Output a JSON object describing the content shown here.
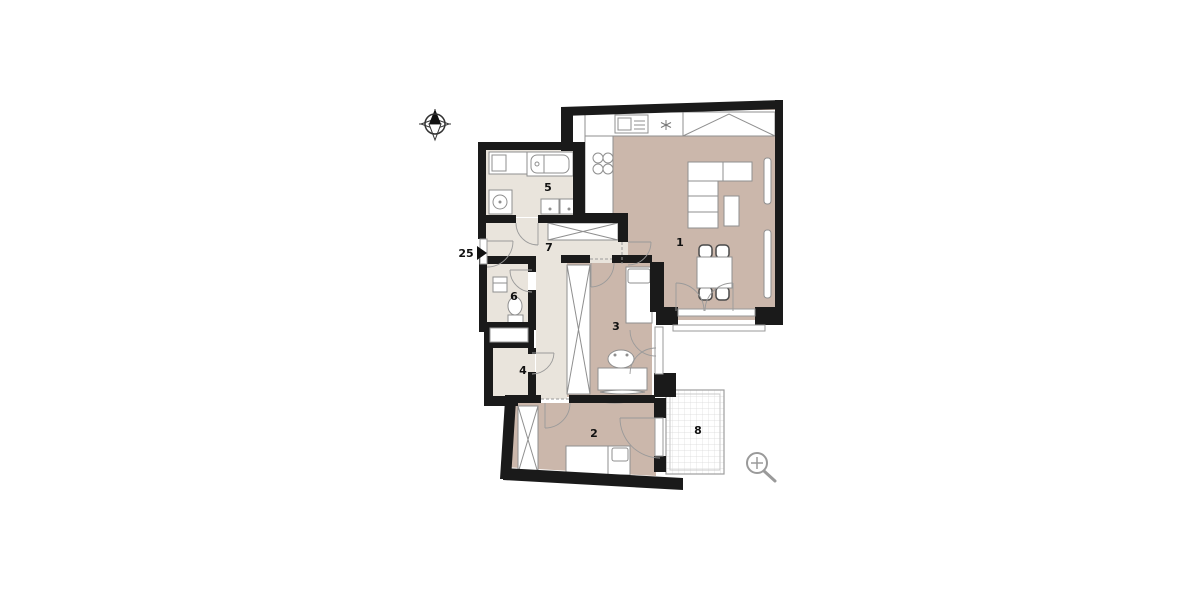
{
  "canvas": {
    "width": 1200,
    "height": 600,
    "background": "#ffffff"
  },
  "plan": {
    "entrance": {
      "label": "25"
    },
    "rooms": [
      {
        "number": "1"
      },
      {
        "number": "2"
      },
      {
        "number": "3"
      },
      {
        "number": "4"
      },
      {
        "number": "5"
      },
      {
        "number": "6"
      },
      {
        "number": "7"
      },
      {
        "number": "8"
      }
    ],
    "icons": [
      {
        "name": "compass-icon"
      },
      {
        "name": "zoom-icon"
      }
    ],
    "colors": {
      "wall": "#1a1a1a",
      "floor_living": "#cbb7ab",
      "floor_service": "#e9e4dc",
      "furniture_outline": "#8f8f8f",
      "fixture_fill": "#ffffff",
      "balcony_grid_line": "#d9d9d9",
      "balcony_border": "#9e9e9e",
      "icon_gray": "#9a9a9a",
      "label_text": "#111111"
    }
  }
}
